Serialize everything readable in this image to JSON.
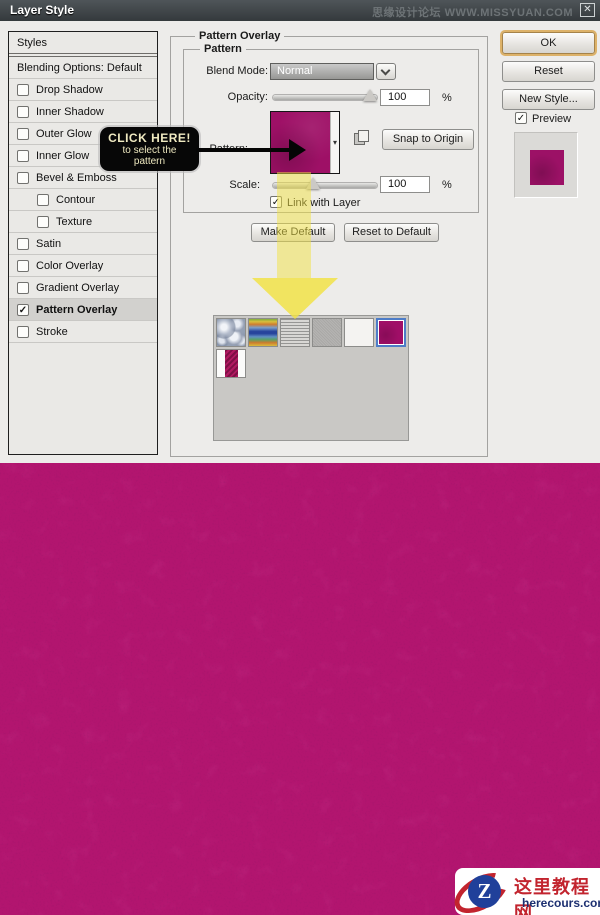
{
  "window": {
    "title": "Layer Style",
    "watermark": "思缘设计论坛 WWW.MISSYUAN.COM",
    "close_label": "✕"
  },
  "glyphs": {
    "check": "✓",
    "dropdown_small": "▾"
  },
  "sidebar": {
    "header": "Styles",
    "items": [
      {
        "id": "blending-options",
        "label": "Blending Options: Default",
        "checkbox": false,
        "checked": false,
        "indent": false,
        "highlight": false
      },
      {
        "id": "drop-shadow",
        "label": "Drop Shadow",
        "checkbox": true,
        "checked": false,
        "indent": false,
        "highlight": false
      },
      {
        "id": "inner-shadow",
        "label": "Inner Shadow",
        "checkbox": true,
        "checked": false,
        "indent": false,
        "highlight": false
      },
      {
        "id": "outer-glow",
        "label": "Outer Glow",
        "checkbox": true,
        "checked": false,
        "indent": false,
        "highlight": false
      },
      {
        "id": "inner-glow",
        "label": "Inner Glow",
        "checkbox": true,
        "checked": false,
        "indent": false,
        "highlight": false
      },
      {
        "id": "bevel-emboss",
        "label": "Bevel & Emboss",
        "checkbox": true,
        "checked": false,
        "indent": false,
        "highlight": false
      },
      {
        "id": "contour",
        "label": "Contour",
        "checkbox": true,
        "checked": false,
        "indent": true,
        "highlight": false
      },
      {
        "id": "texture",
        "label": "Texture",
        "checkbox": true,
        "checked": false,
        "indent": true,
        "highlight": false
      },
      {
        "id": "satin",
        "label": "Satin",
        "checkbox": true,
        "checked": false,
        "indent": false,
        "highlight": false
      },
      {
        "id": "color-overlay",
        "label": "Color Overlay",
        "checkbox": true,
        "checked": false,
        "indent": false,
        "highlight": false
      },
      {
        "id": "gradient-overlay",
        "label": "Gradient Overlay",
        "checkbox": true,
        "checked": false,
        "indent": false,
        "highlight": false
      },
      {
        "id": "pattern-overlay",
        "label": "Pattern Overlay",
        "checkbox": true,
        "checked": true,
        "indent": false,
        "highlight": true
      },
      {
        "id": "stroke",
        "label": "Stroke",
        "checkbox": true,
        "checked": false,
        "indent": false,
        "highlight": false
      }
    ]
  },
  "panel": {
    "group_title": "Pattern Overlay",
    "inner_group_title": "Pattern",
    "blend_mode": {
      "label": "Blend Mode:",
      "value": "Normal"
    },
    "opacity": {
      "label": "Opacity:",
      "value": "100",
      "unit": "%"
    },
    "pattern_label": "Pattern:",
    "snap_button": "Snap to Origin",
    "scale": {
      "label": "Scale:",
      "value": "100",
      "unit": "%"
    },
    "link_checkbox_label": "Link with Layer",
    "link_checked": true,
    "make_default": "Make Default",
    "reset_default": "Reset to Default"
  },
  "actions": {
    "ok": "OK",
    "reset": "Reset",
    "new_style": "New Style...",
    "preview_label": "Preview",
    "preview_checked": true
  },
  "tooltip": {
    "title": "CLICK HERE!",
    "line1": "to select the",
    "line2": "pattern"
  },
  "picker": {
    "patterns": [
      {
        "id": "bubbles",
        "selected": false
      },
      {
        "id": "tiedye",
        "selected": false
      },
      {
        "id": "newsprint",
        "selected": false
      },
      {
        "id": "graynoise",
        "selected": false
      },
      {
        "id": "white",
        "selected": false
      },
      {
        "id": "magenta",
        "selected": true
      },
      {
        "id": "herringbone",
        "selected": false
      }
    ]
  },
  "logo": {
    "letter": "Z",
    "cn": "这里教程网",
    "en": "herecours.com"
  },
  "colors": {
    "background_magenta": "#b2156f",
    "swatch_magenta": "#9e1066",
    "selection_blue": "#4d7cc7",
    "ok_focus_ring": "#ddb269",
    "arrow_yellow": "#f2e242",
    "titlebar_dark": "#3a3f43"
  }
}
